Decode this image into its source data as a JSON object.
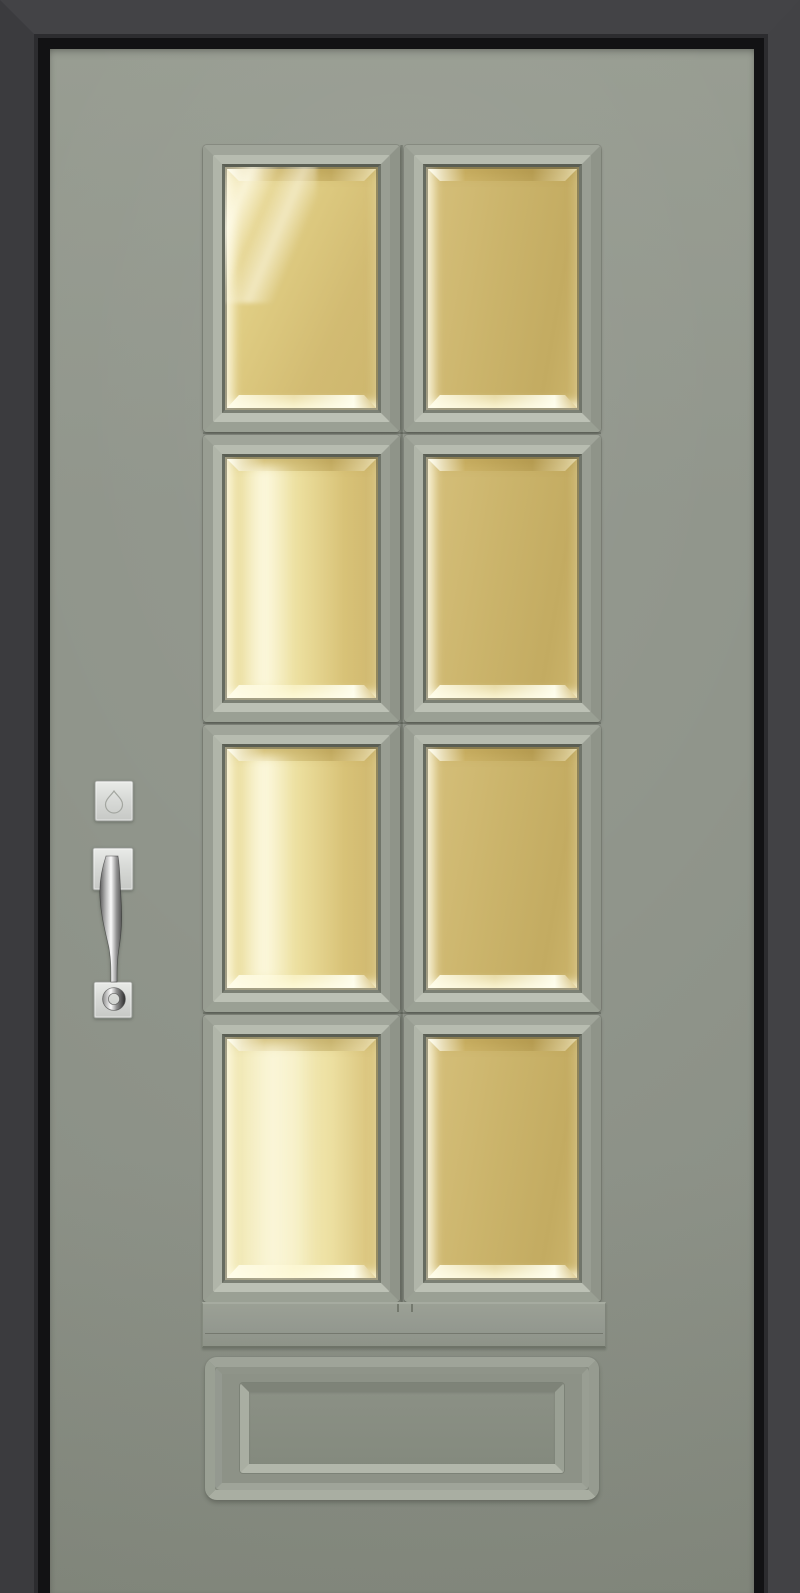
{
  "scene": {
    "type": "3d-render-photo",
    "subject": "front-entry-door-with-glass-lites",
    "door": {
      "slab_color": "#90958b",
      "lite_grid": {
        "rows": 4,
        "columns": 2,
        "glass_color": "#cbb46b",
        "glass_style": "beveled-amber",
        "panes": [
          {
            "id": "r1c1",
            "row": 1,
            "col": 1,
            "variant": "diag"
          },
          {
            "id": "r1c2",
            "row": 1,
            "col": 2,
            "variant": "deep"
          },
          {
            "id": "r2c1",
            "row": 2,
            "col": 1,
            "variant": "vert"
          },
          {
            "id": "r2c2",
            "row": 2,
            "col": 2,
            "variant": "deep"
          },
          {
            "id": "r3c1",
            "row": 3,
            "col": 1,
            "variant": "vert"
          },
          {
            "id": "r3c2",
            "row": 3,
            "col": 2,
            "variant": "deep"
          },
          {
            "id": "r4c1",
            "row": 4,
            "col": 1,
            "variant": "pale"
          },
          {
            "id": "r4c2",
            "row": 4,
            "col": 2,
            "variant": "deep"
          }
        ]
      },
      "bottom_panel": {
        "style": "raised-rectangular",
        "present": true
      },
      "sill_rail": {
        "present": true
      },
      "hardware": {
        "finish": "satin-nickel",
        "finish_color": "#d7d9d6",
        "deadbolt": "square-rosette-thumbturn",
        "handleset": "curved-pull-with-ring-base"
      }
    },
    "frame": {
      "color": "#3b3b3e",
      "style": "mitered-square-casing",
      "reveal_color": "#121214"
    }
  },
  "colors": {
    "door": "#90958b",
    "door-light": "#989d92",
    "door-dark": "#888d82",
    "frame-top": "#434346",
    "frame-left": "#3b3b3e",
    "frame-right": "#424245",
    "frame-step": "#2c2c2f",
    "jamb": "#121214",
    "pane-t": "#a0a59a",
    "pane-r": "#8f9489",
    "pane-bm": "#9aa094",
    "pane-l": "#989d92",
    "bevel-t": "#b7bcb0",
    "bevel-r": "#999e93",
    "bevel-bm": "#bcc1b5",
    "bevel-l": "#b0b5a9",
    "recess-t": "#5a5e53",
    "recess-r": "#70756a",
    "recess-bm": "#7b8074",
    "recess-l": "#666b60",
    "glass-deep": "#cbb46b",
    "glass-mid": "#d8c379",
    "glass-light": "#ecdfa0",
    "glass-pale": "#f2e9b4",
    "glass-bright": "#fdf8dc",
    "bp-t": "#9fa499",
    "bp-r": "#969b90",
    "bp-bm": "#a9aea2",
    "bp-l": "#9aa094",
    "bpi-t": "#7e8378",
    "bpi-r": "#9aa094",
    "bpi-bm": "#b2b7ab",
    "bpi-l": "#a9aea2",
    "metal-dark": "#3f3f3f",
    "metal-mid": "#b9b9b9",
    "metal-bright": "#fbfbfb",
    "plate-light": "#e9ebe8",
    "plate-mid": "#d7d9d6",
    "plate-dark": "#c6c8c5",
    "plate-stroke": "#989b96"
  }
}
